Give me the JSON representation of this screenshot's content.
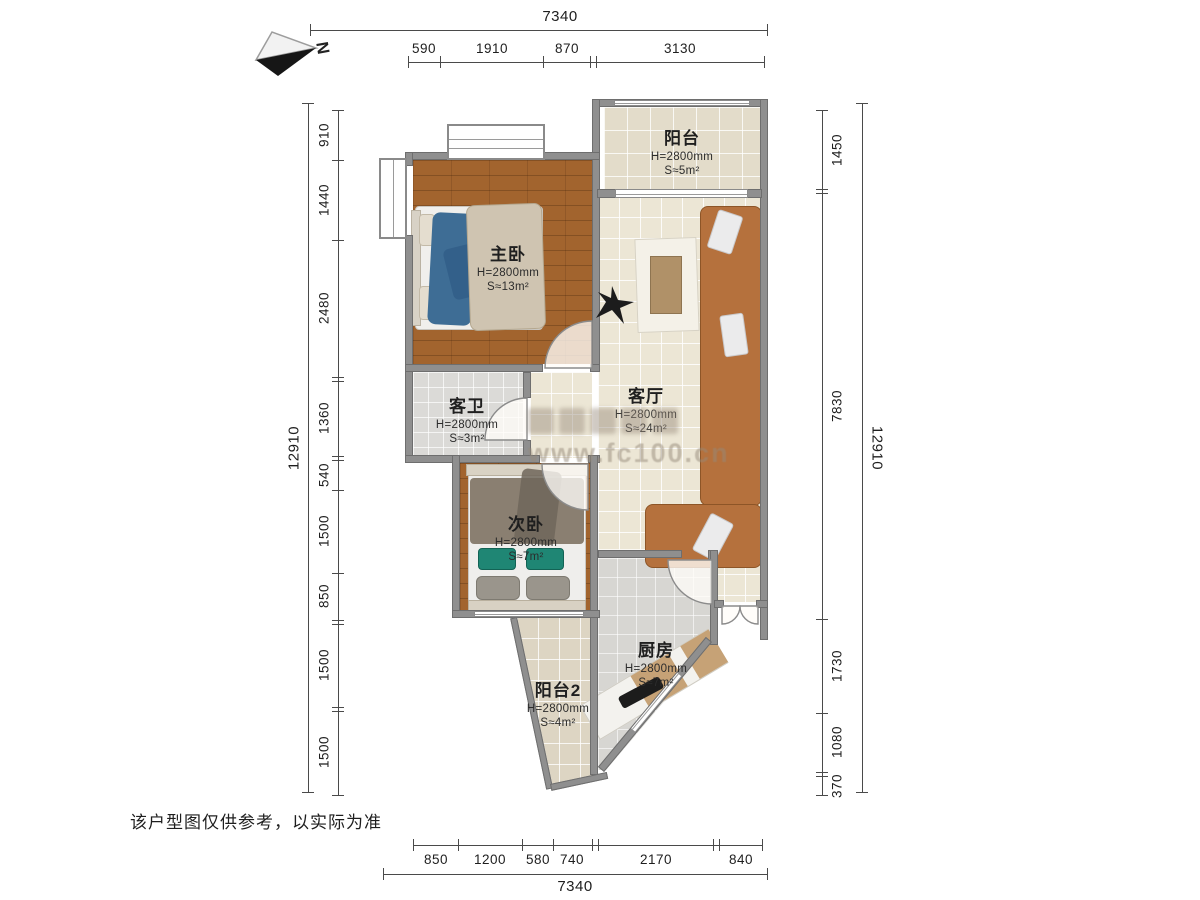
{
  "compass": {
    "label": "N"
  },
  "watermark": {
    "url": "www.fc100.cn"
  },
  "disclaimer": "该户型图仅供参考，以实际为准",
  "rooms": {
    "balcony1": {
      "name": "阳台",
      "height": "H=2800mm",
      "area": "S≈5m²"
    },
    "master": {
      "name": "主卧",
      "height": "H=2800mm",
      "area": "S≈13m²"
    },
    "living": {
      "name": "客厅",
      "height": "H=2800mm",
      "area": "S≈24m²"
    },
    "bathroom": {
      "name": "客卫",
      "height": "H=2800mm",
      "area": "S≈3m²"
    },
    "bedroom2": {
      "name": "次卧",
      "height": "H=2800mm",
      "area": "S≈7m²"
    },
    "kitchen": {
      "name": "厨房",
      "height": "H=2800mm",
      "area": "S≈7m²"
    },
    "balcony2": {
      "name": "阳台2",
      "height": "H=2800mm",
      "area": "S≈4m²"
    }
  },
  "dims": {
    "top": {
      "total": "7340",
      "segments": [
        "590",
        "1910",
        "870",
        "3130"
      ]
    },
    "bottom": {
      "total": "7340",
      "segments": [
        "850",
        "1200",
        "580",
        "740",
        "2170",
        "840"
      ]
    },
    "left": {
      "total": "12910",
      "segments": [
        "910",
        "1440",
        "2480",
        "1360",
        "540",
        "1500",
        "850",
        "1500",
        "1500"
      ]
    },
    "right": {
      "total": "12910",
      "segments": [
        "1450",
        "7830",
        "1730",
        "1080",
        "370"
      ]
    }
  }
}
